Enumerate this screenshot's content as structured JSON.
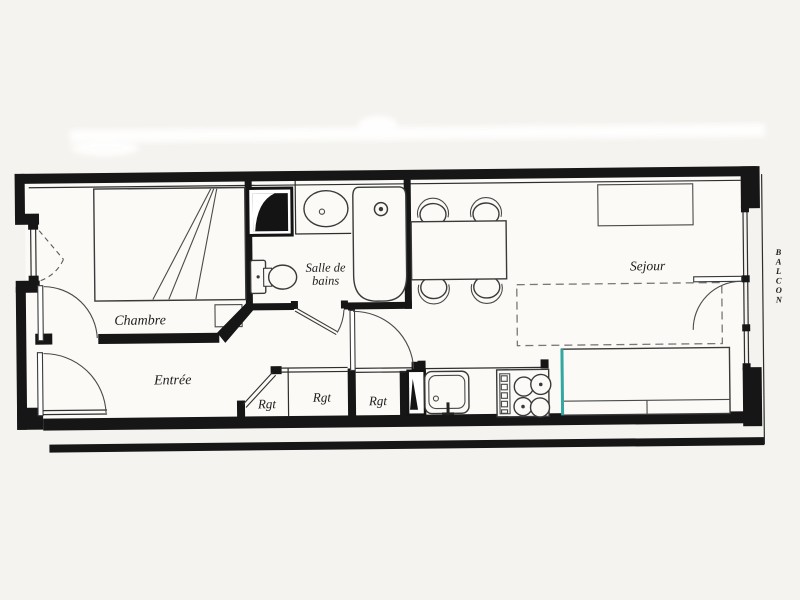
{
  "plan": {
    "rooms": {
      "bedroom": "Chambre",
      "entry": "Entrée",
      "bathroom_line1": "Salle de",
      "bathroom_line2": "bains",
      "living": "Sejour"
    },
    "closets": {
      "label": "Rgt"
    },
    "balcony": {
      "letters": [
        "B",
        "A",
        "L",
        "C",
        "O",
        "N"
      ]
    },
    "colors": {
      "wall": "#161616",
      "paper": "#f5f3ef",
      "accent_teal": "#32a8a1",
      "line": "#2e2e2e",
      "dash": "#787878"
    }
  }
}
